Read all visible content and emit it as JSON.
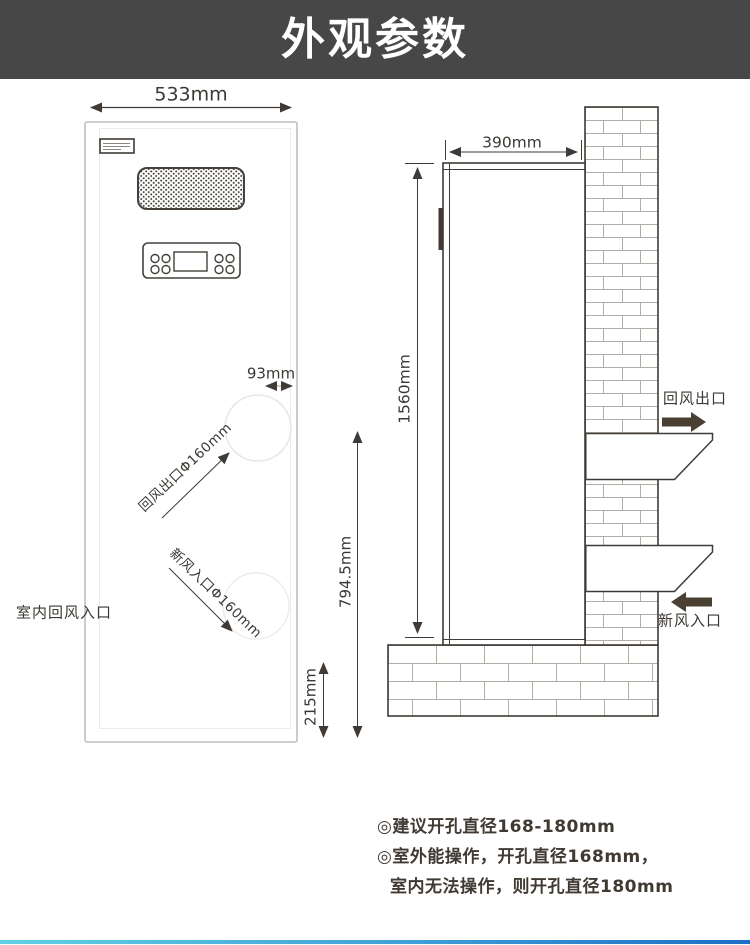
{
  "header": {
    "title": "外观参数"
  },
  "front_view": {
    "width_dim": "533mm",
    "port_offset_dim": "93mm",
    "return_outlet_port_label": "回风出口Φ160mm",
    "fresh_inlet_port_label": "新风入口Φ160mm",
    "indoor_return_inlet_label": "室内回风入口",
    "outlet_height_dim": "794.5mm",
    "inlet_bottom_dim": "215mm"
  },
  "side_view": {
    "depth_dim": "390mm",
    "height_dim": "1560mm",
    "return_outlet_label": "回风出口",
    "fresh_inlet_label": "新风入口"
  },
  "notes": [
    "◎建议开孔直径168-180mm",
    "◎室外能操作，开孔直径168mm，",
    "室内无法操作，则开孔直径180mm"
  ],
  "colors": {
    "header_bg": "#474747",
    "line": "#3f3a35",
    "brick_mortar": "#b2ada5",
    "accent_gradient_start": "#62d0e4",
    "accent_gradient_end": "#1d6fc4"
  }
}
